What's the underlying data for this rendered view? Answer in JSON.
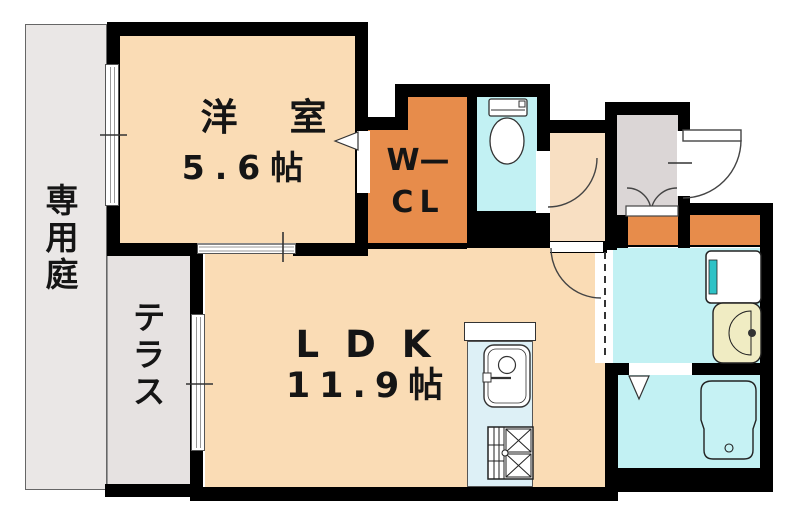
{
  "plan": {
    "type": "apartment-floor-plan",
    "rooms": {
      "private_garden": {
        "label": "専用庭"
      },
      "terrace": {
        "label": "テラス"
      },
      "western_room": {
        "label": "洋室",
        "size": "5.6帖"
      },
      "ldk": {
        "label": "LDK",
        "size": "11.9帖"
      },
      "walk_in_closet": {
        "label_line1": "W—",
        "label_line2": "CL"
      }
    },
    "fixtures": [
      "toilet",
      "kitchen-sink",
      "gas-stove",
      "washing-machine-pan",
      "washbasin",
      "bathtub",
      "entry-door",
      "closet-double-door"
    ],
    "colors": {
      "wall": "#000000",
      "room_peach": "#FADCB5",
      "hall_peach": "#F8DFC2",
      "closet_orange": "#E78C4B",
      "wet_area_cyan": "#C2F1F3",
      "kitchen_blue": "#DDF0F6",
      "entry_gray": "#DBD6D6",
      "garden_gray": "#EAE7E6",
      "terrace_gray": "#E6E2E1",
      "basin_yellow": "#F0ECC3",
      "washer_teal": "#2EC2C6"
    }
  }
}
